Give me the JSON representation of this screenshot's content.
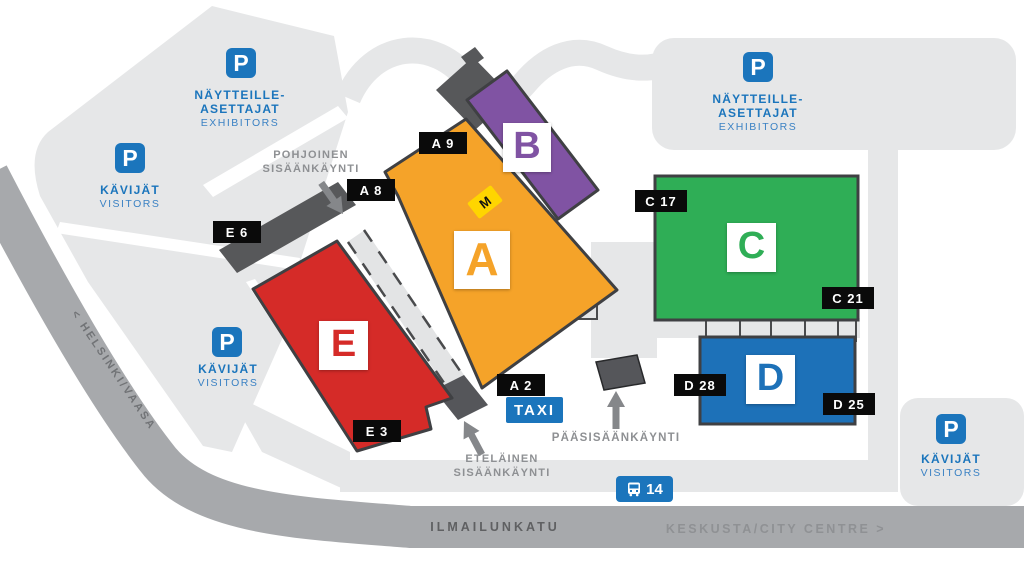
{
  "map": {
    "halls": {
      "a": {
        "letter": "A",
        "color": "#F5A329"
      },
      "b": {
        "letter": "B",
        "color": "#8053A3"
      },
      "c": {
        "letter": "C",
        "color": "#2FAE56"
      },
      "d": {
        "letter": "D",
        "color": "#1D71B8"
      },
      "e": {
        "letter": "E",
        "color": "#D52B28"
      }
    },
    "gates": {
      "a9": "A 9",
      "a8": "A 8",
      "a2": "A 2",
      "e6": "E 6",
      "e3": "E 3",
      "c17": "C 17",
      "c21": "C 21",
      "d28": "D 28",
      "d25": "D 25"
    },
    "parking": {
      "p_symbol": "P",
      "exhibitors_line1": "NÄYTTEILLE-",
      "exhibitors_line2": "ASETTAJAT",
      "exhibitors_line3": "EXHIBITORS",
      "visitors_line1": "KÄVIJÄT",
      "visitors_line2": "VISITORS"
    },
    "entrances": {
      "north_line1": "POHJOINEN",
      "north_line2": "SISÄÄNKÄYNTI",
      "south_line1": "ETELÄINEN",
      "south_line2": "SISÄÄNKÄYNTI",
      "main": "PÄÄSISÄÄNKÄYNTI"
    },
    "transport": {
      "taxi": "TAXI",
      "bus_route": "14",
      "metro": "M"
    },
    "roads": {
      "helsinki_vaasa": "< HELSINKI/VAASA",
      "ilmailunkatu": "ILMAILUNKATU",
      "city_centre": "KESKUSTA/CITY CENTRE >"
    },
    "colors": {
      "parking_blue": "#1B75BC",
      "metro_yellow": "#FFD500",
      "road_gray": "#A7A9AC",
      "area_gray": "#E6E7E8",
      "building_dark": "#57585A"
    }
  }
}
